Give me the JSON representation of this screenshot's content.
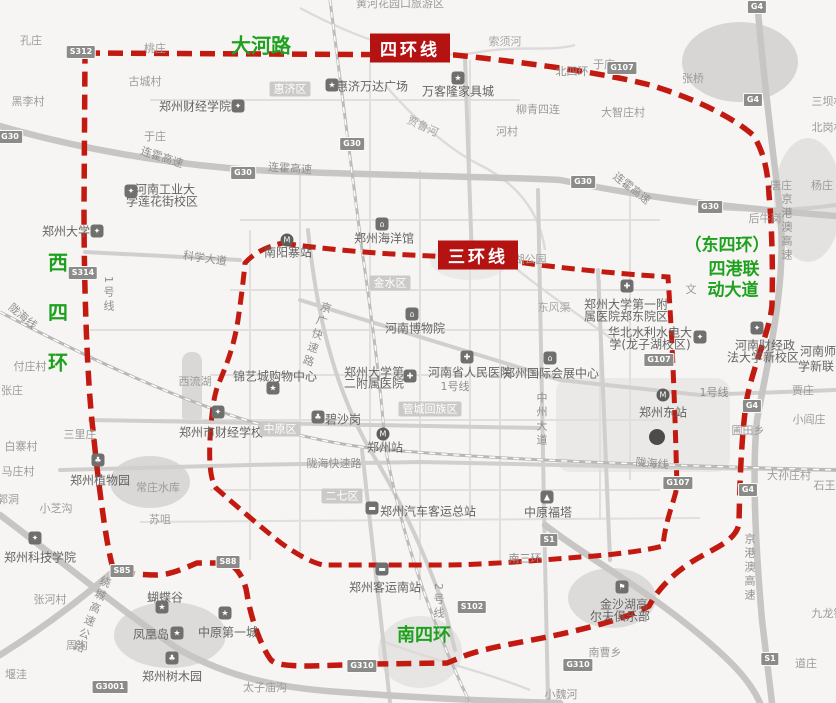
{
  "map": {
    "colors": {
      "ring_red": "#c21a10",
      "annotation_green": "#1fa11f",
      "badge_red": "#b51212"
    },
    "green": {
      "dahe": "大河路",
      "west": "西四环",
      "south": "南四环",
      "east1": "（东四环）",
      "east2": "四港联",
      "east3": "动大道"
    },
    "badges": {
      "ring4": "四环线",
      "ring3": "三环线"
    },
    "districts": [
      {
        "t": "惠济区",
        "x": 290,
        "y": 89
      },
      {
        "t": "金水区",
        "x": 390,
        "y": 283
      },
      {
        "t": "中原区",
        "x": 280,
        "y": 429
      },
      {
        "t": "二七区",
        "x": 342,
        "y": 496
      },
      {
        "t": "管城回族区",
        "x": 430,
        "y": 409
      }
    ],
    "shields": [
      {
        "t": "G30",
        "x": 10,
        "y": 137
      },
      {
        "t": "G30",
        "x": 243,
        "y": 173
      },
      {
        "t": "G30",
        "x": 352,
        "y": 144
      },
      {
        "t": "G30",
        "x": 583,
        "y": 182
      },
      {
        "t": "G30",
        "x": 710,
        "y": 207
      },
      {
        "t": "G107",
        "x": 622,
        "y": 68
      },
      {
        "t": "G107",
        "x": 659,
        "y": 360
      },
      {
        "t": "G107",
        "x": 678,
        "y": 483
      },
      {
        "t": "G4",
        "x": 757,
        "y": 7
      },
      {
        "t": "G4",
        "x": 753,
        "y": 100
      },
      {
        "t": "G4",
        "x": 752,
        "y": 406
      },
      {
        "t": "G4",
        "x": 748,
        "y": 490
      },
      {
        "t": "S1",
        "x": 549,
        "y": 540
      },
      {
        "t": "S1",
        "x": 770,
        "y": 659
      },
      {
        "t": "S102",
        "x": 472,
        "y": 607
      },
      {
        "t": "S312",
        "x": 81,
        "y": 52
      },
      {
        "t": "S314",
        "x": 83,
        "y": 273
      },
      {
        "t": "S85",
        "x": 122,
        "y": 571
      },
      {
        "t": "S88",
        "x": 228,
        "y": 562
      },
      {
        "t": "G310",
        "x": 362,
        "y": 666
      },
      {
        "t": "G310",
        "x": 578,
        "y": 665
      },
      {
        "t": "G3001",
        "x": 110,
        "y": 687
      }
    ],
    "pois": [
      {
        "k": "school",
        "x": 238,
        "y": 106
      },
      {
        "k": "school",
        "x": 131,
        "y": 191
      },
      {
        "k": "school",
        "x": 97,
        "y": 231
      },
      {
        "k": "school",
        "x": 218,
        "y": 412
      },
      {
        "k": "school",
        "x": 700,
        "y": 337
      },
      {
        "k": "school",
        "x": 757,
        "y": 328
      },
      {
        "k": "school",
        "x": 35,
        "y": 538
      },
      {
        "k": "hospital",
        "x": 627,
        "y": 286
      },
      {
        "k": "hospital",
        "x": 410,
        "y": 376
      },
      {
        "k": "hospital",
        "x": 467,
        "y": 357
      },
      {
        "k": "museum",
        "x": 412,
        "y": 314
      },
      {
        "k": "museum",
        "x": 550,
        "y": 358
      },
      {
        "k": "museum",
        "x": 382,
        "y": 224
      },
      {
        "k": "metro",
        "x": 287,
        "y": 240
      },
      {
        "k": "metro",
        "x": 383,
        "y": 434
      },
      {
        "k": "metro",
        "x": 663,
        "y": 395
      },
      {
        "k": "tree",
        "x": 318,
        "y": 417
      },
      {
        "k": "tree",
        "x": 98,
        "y": 460
      },
      {
        "k": "tree",
        "x": 172,
        "y": 658
      },
      {
        "k": "bus",
        "x": 372,
        "y": 508
      },
      {
        "k": "bus",
        "x": 382,
        "y": 569
      },
      {
        "k": "tower",
        "x": 547,
        "y": 497
      },
      {
        "k": "golf",
        "x": 622,
        "y": 587
      },
      {
        "k": "star",
        "x": 332,
        "y": 85
      },
      {
        "k": "star",
        "x": 458,
        "y": 78
      },
      {
        "k": "star",
        "x": 273,
        "y": 388
      },
      {
        "k": "star",
        "x": 162,
        "y": 607
      },
      {
        "k": "star",
        "x": 177,
        "y": 633
      },
      {
        "k": "star",
        "x": 225,
        "y": 613
      },
      {
        "k": "bigdot",
        "x": 657,
        "y": 437
      }
    ],
    "labels": [
      {
        "t": "黄河花园口旅游区",
        "x": 400,
        "y": 3
      },
      {
        "t": "孔庄",
        "x": 31,
        "y": 40
      },
      {
        "t": "桃庄",
        "x": 155,
        "y": 48
      },
      {
        "t": "古城村",
        "x": 145,
        "y": 81
      },
      {
        "t": "黑李村",
        "x": 28,
        "y": 101
      },
      {
        "t": "于庄",
        "x": 155,
        "y": 136
      },
      {
        "t": "于庄",
        "x": 604,
        "y": 64
      },
      {
        "t": "河村",
        "x": 507,
        "y": 131
      },
      {
        "t": "柳青四连",
        "x": 538,
        "y": 109
      },
      {
        "t": "张桥",
        "x": 693,
        "y": 78
      },
      {
        "t": "大智庄村",
        "x": 623,
        "y": 112
      },
      {
        "t": "三坝村",
        "x": 828,
        "y": 101
      },
      {
        "t": "北岗村",
        "x": 828,
        "y": 127
      },
      {
        "t": "唐庄",
        "x": 781,
        "y": 185
      },
      {
        "t": "杨庄",
        "x": 822,
        "y": 185
      },
      {
        "t": "后牛岗",
        "x": 765,
        "y": 218
      },
      {
        "t": "付庄村",
        "x": 30,
        "y": 366
      },
      {
        "t": "张庄",
        "x": 12,
        "y": 390
      },
      {
        "t": "白寨村",
        "x": 21,
        "y": 446
      },
      {
        "t": "马庄村",
        "x": 18,
        "y": 471
      },
      {
        "t": "郭洞",
        "x": 8,
        "y": 499
      },
      {
        "t": "小芝沟",
        "x": 56,
        "y": 508
      },
      {
        "t": "三里庄",
        "x": 80,
        "y": 434
      },
      {
        "t": "苏咀",
        "x": 160,
        "y": 519
      },
      {
        "t": "常庄水库",
        "x": 158,
        "y": 487
      },
      {
        "t": "西流湖",
        "x": 195,
        "y": 381
      },
      {
        "t": "张河村",
        "x": 50,
        "y": 599
      },
      {
        "t": "周沟",
        "x": 77,
        "y": 645
      },
      {
        "t": "堰洼",
        "x": 16,
        "y": 674
      },
      {
        "t": "太子庙沟",
        "x": 265,
        "y": 687
      },
      {
        "t": "南曹乡",
        "x": 605,
        "y": 652
      },
      {
        "t": "小魏河",
        "x": 561,
        "y": 694
      },
      {
        "t": "贾庄",
        "x": 803,
        "y": 390
      },
      {
        "t": "小阎庄",
        "x": 809,
        "y": 419
      },
      {
        "t": "大孙庄村",
        "x": 789,
        "y": 475
      },
      {
        "t": "石王村",
        "x": 830,
        "y": 485
      },
      {
        "t": "圃田乡",
        "x": 748,
        "y": 430
      },
      {
        "t": "九龙镇",
        "x": 828,
        "y": 613
      },
      {
        "t": "道庄",
        "x": 806,
        "y": 663
      },
      {
        "t": "文",
        "x": 691,
        "y": 289
      },
      {
        "t": "湖公园",
        "x": 530,
        "y": 259
      },
      {
        "t": "东风渠",
        "x": 554,
        "y": 307,
        "c": "riv"
      },
      {
        "t": "索须河",
        "x": 505,
        "y": 41,
        "c": "riv"
      },
      {
        "t": "贾鲁河",
        "x": 423,
        "y": 126,
        "c": "riv",
        "r": 25
      },
      {
        "t": "北四环",
        "x": 572,
        "y": 71,
        "c": "road"
      },
      {
        "t": "连霍高速",
        "x": 162,
        "y": 157,
        "c": "road",
        "r": 18
      },
      {
        "t": "连霍高速",
        "x": 290,
        "y": 168,
        "c": "road",
        "r": 4
      },
      {
        "t": "连霍高速",
        "x": 632,
        "y": 188,
        "c": "road",
        "r": 38
      },
      {
        "t": "科学大道",
        "x": 205,
        "y": 258,
        "c": "road",
        "r": 8
      },
      {
        "t": "陇海线",
        "x": 23,
        "y": 316,
        "c": "road",
        "r": 40
      },
      {
        "t": "陇海线",
        "x": 652,
        "y": 463,
        "c": "road",
        "r": 5
      },
      {
        "t": "陇海快速路",
        "x": 334,
        "y": 463,
        "c": "road"
      },
      {
        "t": "南三环",
        "x": 525,
        "y": 558,
        "c": "road"
      },
      {
        "t": "1号线",
        "x": 108,
        "y": 295,
        "c": "road",
        "v": 1
      },
      {
        "t": "1号线",
        "x": 455,
        "y": 386,
        "c": "road"
      },
      {
        "t": "1号线",
        "x": 714,
        "y": 392,
        "c": "road"
      },
      {
        "t": "2号线",
        "x": 438,
        "y": 602,
        "c": "road",
        "v": 1
      },
      {
        "t": "中州大道",
        "x": 541,
        "y": 420,
        "c": "road",
        "v": 1
      },
      {
        "t": "京广快速路",
        "x": 316,
        "y": 335,
        "c": "road",
        "v": 1,
        "r": 18
      },
      {
        "t": "京港澳高速",
        "x": 786,
        "y": 228,
        "c": "road",
        "v": 1
      },
      {
        "t": "京港澳高速",
        "x": 749,
        "y": 568,
        "c": "road",
        "v": 1
      },
      {
        "t": "绕城高速公路",
        "x": 91,
        "y": 615,
        "c": "road",
        "v": 1,
        "r": 22
      },
      {
        "t": "郑州财经学院",
        "x": 195,
        "y": 106,
        "c": "dark"
      },
      {
        "t": "河南工业大",
        "x": 165,
        "y": 189,
        "c": "dark"
      },
      {
        "t": "学莲花街校区",
        "x": 162,
        "y": 201,
        "c": "dark"
      },
      {
        "t": "郑州大学",
        "x": 66,
        "y": 231,
        "c": "dark"
      },
      {
        "t": "惠济万达广场",
        "x": 372,
        "y": 86,
        "c": "dark"
      },
      {
        "t": "万客隆家具城",
        "x": 458,
        "y": 91,
        "c": "dark"
      },
      {
        "t": "郑州海洋馆",
        "x": 384,
        "y": 238,
        "c": "dark"
      },
      {
        "t": "南阳寨站",
        "x": 288,
        "y": 252,
        "c": "dark"
      },
      {
        "t": "河南博物院",
        "x": 415,
        "y": 328,
        "c": "dark"
      },
      {
        "t": "郑州大学第一附",
        "x": 626,
        "y": 304,
        "c": "dark"
      },
      {
        "t": "属医院郑东院区",
        "x": 626,
        "y": 316,
        "c": "dark"
      },
      {
        "t": "华北水利水电大",
        "x": 650,
        "y": 332,
        "c": "dark"
      },
      {
        "t": "学(龙子湖校区)",
        "x": 650,
        "y": 344,
        "c": "dark"
      },
      {
        "t": "河南财经政",
        "x": 765,
        "y": 345,
        "c": "dark"
      },
      {
        "t": "法大学新校区",
        "x": 763,
        "y": 357,
        "c": "dark"
      },
      {
        "t": "河南师",
        "x": 818,
        "y": 351,
        "c": "dark"
      },
      {
        "t": "学新联",
        "x": 816,
        "y": 366,
        "c": "dark"
      },
      {
        "t": "锦艺城购物中心",
        "x": 275,
        "y": 376,
        "c": "dark"
      },
      {
        "t": "郑州大学第",
        "x": 374,
        "y": 372,
        "c": "dark"
      },
      {
        "t": "二附属医院",
        "x": 374,
        "y": 383,
        "c": "dark"
      },
      {
        "t": "河南省人民医院",
        "x": 470,
        "y": 372,
        "c": "dark"
      },
      {
        "t": "郑州国际会展中心",
        "x": 551,
        "y": 373,
        "c": "dark"
      },
      {
        "t": "郑州东站",
        "x": 663,
        "y": 412,
        "c": "dark"
      },
      {
        "t": "郑州市财经学校",
        "x": 221,
        "y": 432,
        "c": "dark"
      },
      {
        "t": "碧沙岗",
        "x": 343,
        "y": 419,
        "c": "dark"
      },
      {
        "t": "郑州站",
        "x": 385,
        "y": 447,
        "c": "dark"
      },
      {
        "t": "郑州汽车客运总站",
        "x": 428,
        "y": 511,
        "c": "dark"
      },
      {
        "t": "中原福塔",
        "x": 548,
        "y": 512,
        "c": "dark"
      },
      {
        "t": "郑州客运南站",
        "x": 385,
        "y": 587,
        "c": "dark"
      },
      {
        "t": "金沙湖高",
        "x": 624,
        "y": 604,
        "c": "dark"
      },
      {
        "t": "尔夫俱乐部",
        "x": 620,
        "y": 616,
        "c": "dark"
      },
      {
        "t": "蝴蝶谷",
        "x": 165,
        "y": 597,
        "c": "dark"
      },
      {
        "t": "凤凰岛",
        "x": 151,
        "y": 634,
        "c": "dark"
      },
      {
        "t": "中原第一城",
        "x": 228,
        "y": 632,
        "c": "dark"
      },
      {
        "t": "郑州树木园",
        "x": 172,
        "y": 676,
        "c": "dark"
      },
      {
        "t": "郑州植物园",
        "x": 100,
        "y": 480,
        "c": "dark"
      },
      {
        "t": "郑州科技学院",
        "x": 40,
        "y": 557,
        "c": "dark"
      }
    ]
  }
}
